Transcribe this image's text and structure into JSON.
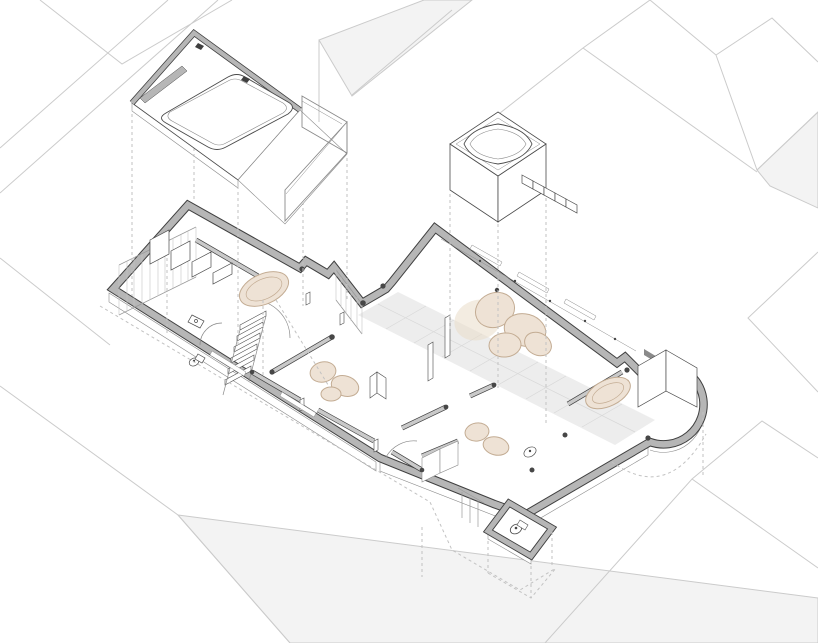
{
  "canvas": {
    "width": 818,
    "height": 643
  },
  "drawing": {
    "kind": "exploded axonometric floor plan",
    "context_label": "surrounding-roofscape",
    "plan_label": "apartment-floor-plan",
    "terrace_label": "detached-roof-terrace-plate",
    "rooflight_label": "detached-rooflight-box-with-steps"
  },
  "colors": {
    "background": "#ffffff",
    "context_line": "#cbcbcb",
    "context_fill": "#f3f3f3",
    "wall_top": "#b6b6b6",
    "wall_edge": "#3f3f3f",
    "partition_top": "#c9c9c9",
    "line_dark": "#4a4a4a",
    "line_mid": "#8a8a8a",
    "line_light": "#c4c4c4",
    "dash": "#c2c2c2",
    "floor_tile": "#ededed",
    "tile_joint": "#d8d8d8",
    "glass": "#9a9a9a",
    "white": "#ffffff",
    "furniture_fill": "#eee2d5",
    "furniture_edge": "#c3ac93",
    "furniture_shadow": "#e9dcc9",
    "column_dot": "#474747"
  }
}
